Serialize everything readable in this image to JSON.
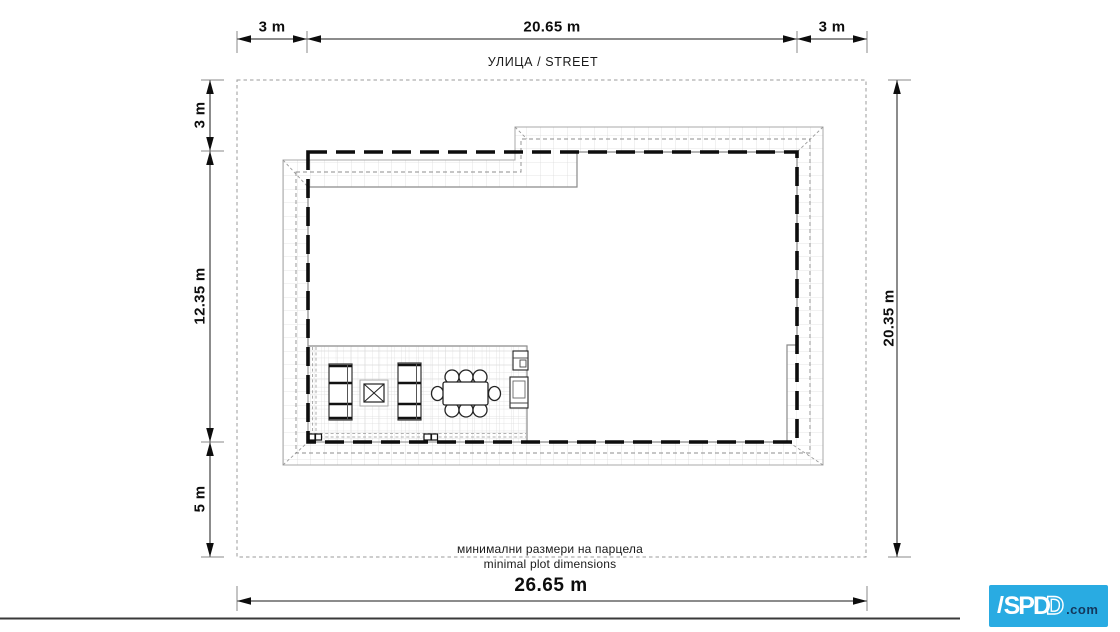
{
  "drawing": {
    "street_label": "УЛИЦА / STREET",
    "caption_line1": "минимални размери на парцела",
    "caption_line2": "minimal plot dimensions"
  },
  "dimensions": {
    "top_left": "3 m",
    "top_center": "20.65 m",
    "top_right": "3 m",
    "left_upper": "3 m",
    "left_middle": "12.35 m",
    "left_lower": "5 m",
    "right_full": "20.35 m",
    "bottom_full": "26.65 m"
  },
  "logo": {
    "main": "SPD",
    "outline_letter": "D",
    "suffix": ".com",
    "background": "#29ABE2",
    "suffix_color": "#14375C"
  },
  "colors": {
    "envelope_line": "#0d0d0d",
    "dimension_line": "#1a1a1a",
    "grid_line": "#dcdcdc",
    "roof_edge": "#a8a8a8",
    "wall_line": "#8a8a8a",
    "plot_boundary": "#9b9b9b"
  }
}
